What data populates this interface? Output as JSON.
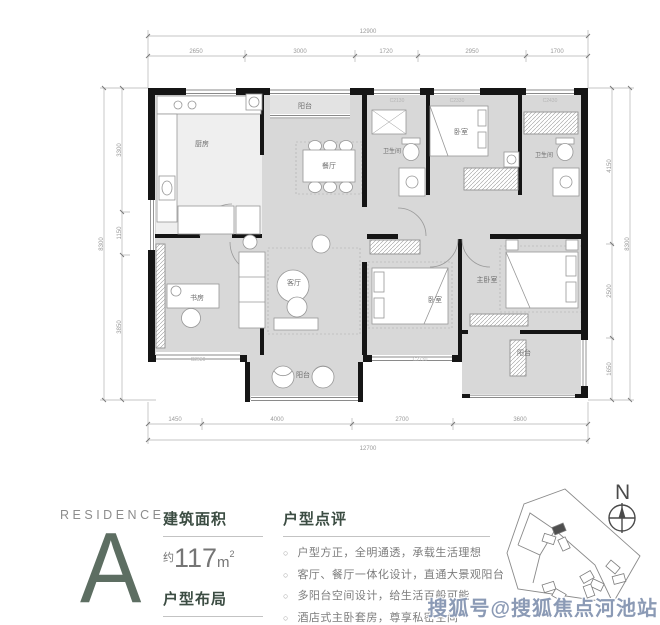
{
  "floorplan": {
    "rooms": {
      "kitchen": "厨房",
      "balcony_top": "阳台",
      "dining": "餐厅",
      "bath_left": "卫生间",
      "bedroom_top": "卧室",
      "bath_right": "卫生间",
      "study": "书房",
      "living": "客厅",
      "bedroom_bottom": "卧室",
      "master_bedroom": "主卧室",
      "balcony_right": "阳台",
      "balcony_bottom": "阳台"
    },
    "dims": {
      "top_total": "12900",
      "top_segments": [
        "2650",
        "3000",
        "1720",
        "2950",
        "1700"
      ],
      "bottom_segments": [
        "1450",
        "4000",
        "2700",
        "3600"
      ],
      "bottom_total": "12700",
      "left_total": "8300",
      "left_segments": [
        "3300",
        "1150",
        "3850"
      ],
      "right_segments": [
        "4150",
        "2500",
        "1650"
      ],
      "right_total": "8300"
    },
    "window_codes": [
      "C2130",
      "C2330",
      "C2430",
      "C2930",
      "C2730"
    ]
  },
  "info": {
    "residence_label": "RESIDENCE",
    "unit_letter": "A",
    "area_title": "建筑面积",
    "area_approx": "约",
    "area_value": "117",
    "area_unit": "m",
    "area_sup": "2",
    "layout_title": "户型布局",
    "layout_value": "四房两厅两卫",
    "review_title": "户型点评",
    "bullet_char": "○",
    "review_items": [
      "户型方正，全明通透，承载生活理想",
      "客厅、餐厅一体化设计，直通大景观阳台",
      "多阳台空间设计，给生活百般可能",
      "酒店式主卧套房，尊享私密空间"
    ]
  },
  "site": {
    "north": "N"
  },
  "watermark": "搜狐号@搜狐焦点河池站",
  "colors": {
    "accent_green": "#5d6e62",
    "heading_green": "#3c4d43",
    "wall_black": "#151515",
    "floor_gray": "#d8d8d8",
    "watermark_blue": "#8b9ab5"
  }
}
